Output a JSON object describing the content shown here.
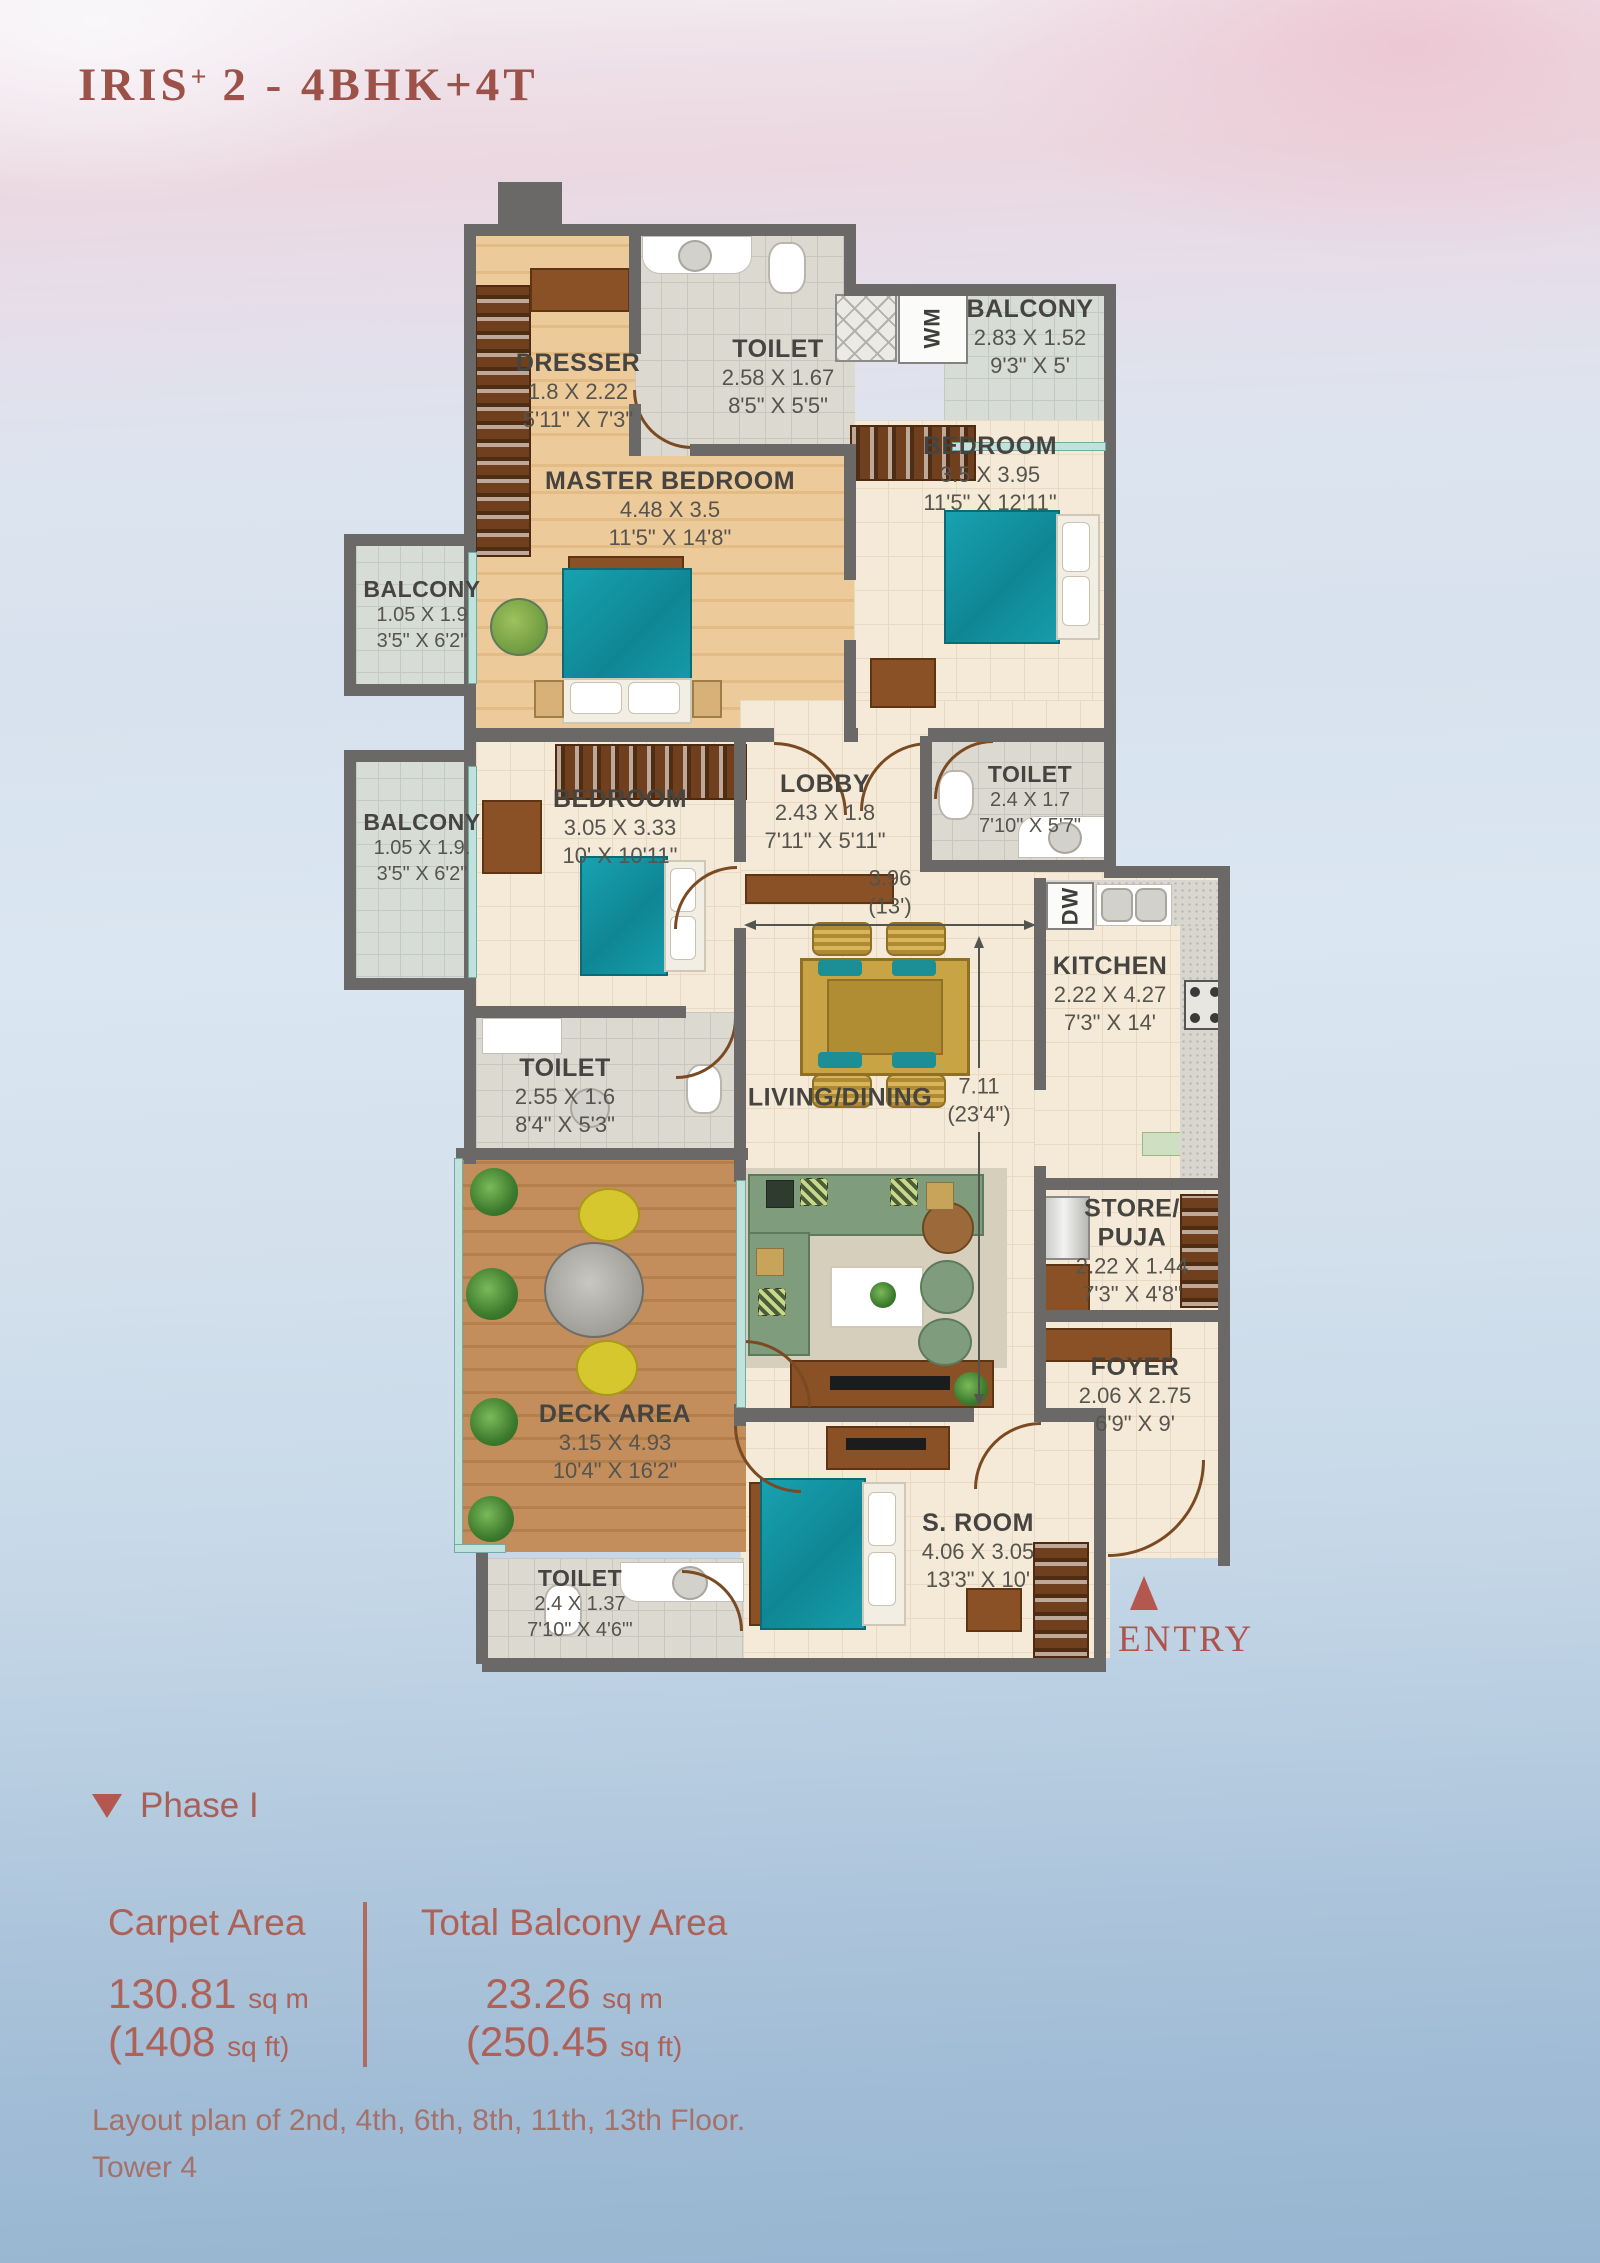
{
  "title": {
    "main": "IRIS",
    "sup": "+",
    "rest": " 2 - 4BHK+4T"
  },
  "plan": {
    "rooms": {
      "dresser": {
        "name": "DRESSER",
        "dim_m": "1.8 X 2.22",
        "dim_ft": "5'11\" X 7'3\""
      },
      "master_toilet": {
        "name": "TOILET",
        "dim_m": "2.58 X 1.67",
        "dim_ft": "8'5\" X 5'5\""
      },
      "master_bedroom": {
        "name": "MASTER BEDROOM",
        "dim_m": "4.48 X 3.5",
        "dim_ft": "11'5\" X 14'8\""
      },
      "balcony_tr": {
        "name": "BALCONY",
        "dim_m": "2.83 X 1.52",
        "dim_ft": "9'3\" X 5'"
      },
      "bedroom_tr": {
        "name": "BEDROOM",
        "dim_m": "3.5 X 3.95",
        "dim_ft": "11'5\" X 12'11\""
      },
      "balcony_l1": {
        "name": "BALCONY",
        "dim_m": "1.05 X 1.9",
        "dim_ft": "3'5\" X 6'2\""
      },
      "balcony_l2": {
        "name": "BALCONY",
        "dim_m": "1.05 X 1.9.",
        "dim_ft": "3'5\" X 6'2\""
      },
      "bedroom_mid": {
        "name": "BEDROOM",
        "dim_m": "3.05 X 3.33",
        "dim_ft": "10' X 10'11\""
      },
      "lobby": {
        "name": "LOBBY",
        "dim_m": "2.43 X 1.8",
        "dim_ft": "7'11\" X 5'11\""
      },
      "toilet_center": {
        "name": "TOILET",
        "dim_m": "2.4 X 1.7",
        "dim_ft": "7'10\" X 5'7\""
      },
      "kitchen": {
        "name": "KITCHEN",
        "dim_m": "2.22 X 4.27",
        "dim_ft": "7'3\" X 14'"
      },
      "toilet_midleft": {
        "name": "TOILET",
        "dim_m": "2.55 X 1.6",
        "dim_ft": "8'4\" X 5'3\""
      },
      "living_dining": {
        "name": "LIVING/DINING"
      },
      "store_puja": {
        "name": "STORE/",
        "name2": "PUJA",
        "dim_m": "2.22 X 1.44",
        "dim_ft": "7'3\" X 4'8\""
      },
      "foyer": {
        "name": "FOYER",
        "dim_m": "2.06 X 2.75",
        "dim_ft": "6'9\" X 9'"
      },
      "deck": {
        "name": "DECK AREA",
        "dim_m": "3.15 X 4.93",
        "dim_ft": "10'4\" X 16'2\""
      },
      "toilet_bottom": {
        "name": "TOILET",
        "dim_m": "2.4 X 1.37",
        "dim_ft": "7'10\" X 4'6\"'"
      },
      "s_room": {
        "name": "S. ROOM",
        "dim_m": "4.06 X 3.05",
        "dim_ft": "13'3\" X 10'"
      }
    },
    "appliances": {
      "wm": "WM",
      "dw": "DW"
    },
    "dimensions": {
      "horizontal": {
        "value": "3.96",
        "sub": "(13')"
      },
      "vertical": {
        "value": "7.11",
        "sub": "(23'4\")"
      }
    },
    "entry_label": "ENTRY"
  },
  "phase": {
    "label": "Phase I"
  },
  "areas": {
    "carpet": {
      "title": "Carpet Area",
      "metric": "130.81",
      "metric_unit": "sq m",
      "imperial": "(1408",
      "imperial_unit": "sq ft)"
    },
    "balcony": {
      "title": "Total Balcony Area",
      "metric": "23.26",
      "metric_unit": "sq m",
      "imperial": "(250.45",
      "imperial_unit": "sq ft)"
    }
  },
  "footer": {
    "line1": "Layout plan of 2nd, 4th, 6th, 8th, 11th, 13th Floor.",
    "line2": "Tower 4"
  },
  "colors": {
    "accent_maroon": "#9c5248",
    "wall_gray": "#6b6968",
    "bed_teal": "#149aa8",
    "wood": "#ecca9a",
    "watercolor_blue": "#a2bdd6",
    "watercolor_pink": "#ecc5d1"
  }
}
